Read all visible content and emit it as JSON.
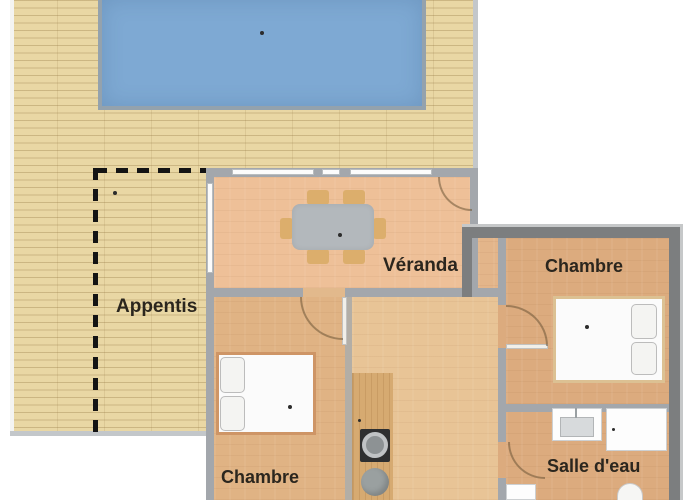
{
  "plan": {
    "rooms": [
      {
        "name": "appentis",
        "label": "Appentis"
      },
      {
        "name": "veranda",
        "label": "Véranda"
      },
      {
        "name": "chambre-nord",
        "label": "Chambre"
      },
      {
        "name": "chambre-sud",
        "label": "Chambre"
      },
      {
        "name": "salle-deau",
        "label": "Salle d'eau"
      }
    ],
    "colors": {
      "deck": "#e9d7a4",
      "pool": "#7ea9d3",
      "pool_border": "#94a2ad",
      "veranda_floor": "#eec098",
      "hall_floor": "#e8c496",
      "chambre_sud_floor": "#e0b384",
      "chambre_nord_floor": "#dcab7e",
      "wall_light": "#a3a7ac",
      "wall_dark": "#7c7e7f",
      "chair": "#dcae6c",
      "table": "#b3b8bc",
      "dash": "#141414",
      "label_text": "#2b261e"
    }
  }
}
